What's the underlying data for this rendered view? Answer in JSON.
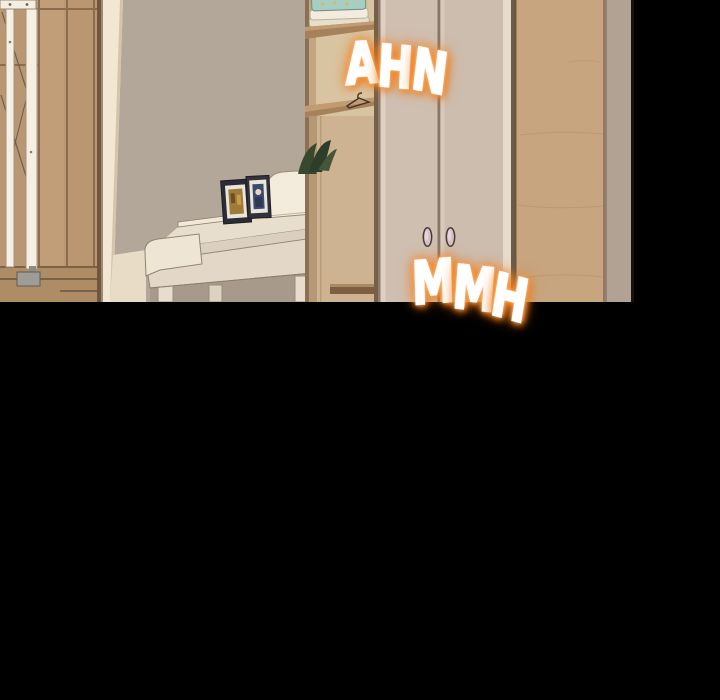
{
  "sfx": [
    {
      "id": "ahn",
      "text": "AHN",
      "letters": [
        "A",
        "H",
        "N"
      ],
      "style": "white-letters-orange-glow"
    },
    {
      "id": "mmh",
      "text": "MMH",
      "letters": [
        "M",
        "M",
        "H"
      ],
      "style": "white-letters-orange-glow"
    }
  ],
  "colors": {
    "background_black": "#000000",
    "wall": "#b3a79a",
    "wall_right_strip": "#b1a294",
    "left_wardrobe_wood": "#b89772",
    "door_frame_trim": "#f2e7d3",
    "gate_white": "#f5efe3",
    "gate_foot_gray": "#9e9c97",
    "piano_cream": "#e8decd",
    "piano_top": "#f1e8d9",
    "music_sheet": "#f3ebdc",
    "photo_frame_dark": "#2c2c34",
    "shelf_interior": "#d9c4a2",
    "shelf_board": "#a5825c",
    "shelf_lower_panel": "#cdb392",
    "towel_teal": "#a7cec0",
    "towel_white": "#f1ecdf",
    "wardrobe_door": "#cfbfb1",
    "door_handle_pink": "#d8bfc6",
    "wood_panel_right": "#c7a57f",
    "plant_green": "#35462f",
    "sfx_fill": "#ffffff",
    "sfx_glow_orange": "#f5821e"
  }
}
